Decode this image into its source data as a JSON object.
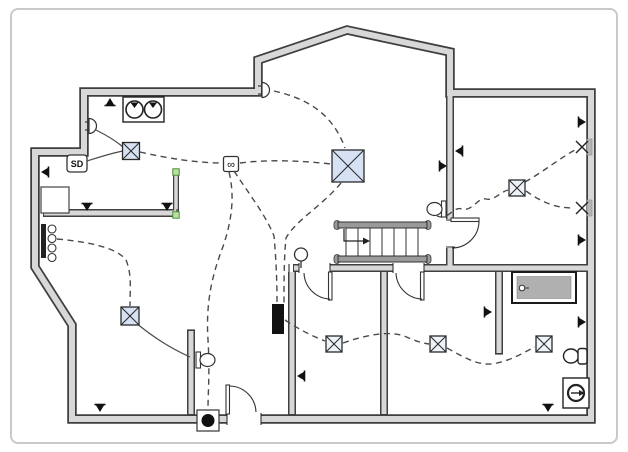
{
  "app": {
    "type": "electrical-floor-plan-diagram"
  },
  "labels": {
    "smoke_detector": "SD",
    "junction_infinity": "∞"
  },
  "colors": {
    "wall_fill": "#d8d8d8",
    "wall_edge": "#3f3f3f",
    "wire": "#4a4a4a",
    "junction_fill_blue": "#d6e2f3",
    "junction_fill_light": "#eef2f9",
    "selection_handle": "#b9e29c",
    "selection_handle_edge": "#4a8f3c",
    "frame_border": "#c9c9c9",
    "tub_fill": "#b0b0b0",
    "stair_stringer": "#9a9a9a",
    "panel_fill": "#111111"
  },
  "symbols": {
    "duplex_outlets": [
      {
        "x": 110,
        "y": 98,
        "rot": 0
      },
      {
        "x": 41,
        "y": 172,
        "rot": -90
      },
      {
        "x": 87,
        "y": 211,
        "rot": 180
      },
      {
        "x": 167,
        "y": 211,
        "rot": 180
      },
      {
        "x": 100,
        "y": 412,
        "rot": 180
      },
      {
        "x": 297,
        "y": 376,
        "rot": -90
      },
      {
        "x": 548,
        "y": 412,
        "rot": 180
      },
      {
        "x": 586,
        "y": 122,
        "rot": 90
      },
      {
        "x": 586,
        "y": 240,
        "rot": 90
      },
      {
        "x": 586,
        "y": 322,
        "rot": 90
      },
      {
        "x": 492,
        "y": 312,
        "rot": 90
      },
      {
        "x": 455,
        "y": 151,
        "rot": -90
      },
      {
        "x": 447,
        "y": 166,
        "rot": 90
      }
    ],
    "junction_boxes": [
      {
        "x": 348,
        "y": 166,
        "size": 32,
        "fill": "#d6e2f3"
      },
      {
        "x": 131,
        "y": 151,
        "size": 17,
        "fill": "#d6e2f3"
      },
      {
        "x": 130,
        "y": 316,
        "size": 18,
        "fill": "#d6e2f3"
      },
      {
        "x": 334,
        "y": 344,
        "size": 16,
        "fill": "#eef2f9"
      },
      {
        "x": 438,
        "y": 344,
        "size": 16,
        "fill": "#eef2f9"
      },
      {
        "x": 544,
        "y": 344,
        "size": 16,
        "fill": "#eef2f9"
      },
      {
        "x": 517,
        "y": 188,
        "size": 16,
        "fill": "#eef2f9"
      }
    ],
    "wall_x_lights": [
      {
        "x": 582,
        "y": 147
      },
      {
        "x": 582,
        "y": 208
      }
    ],
    "dome_wall_lights": [
      {
        "x": 262,
        "y": 90
      },
      {
        "x": 89,
        "y": 126
      }
    ],
    "oval_wall_lights": [
      {
        "x": 446,
        "y": 209,
        "dir": -1
      },
      {
        "x": 196,
        "y": 360,
        "dir": 1
      }
    ],
    "selection_handles": [
      {
        "x": 176,
        "y": 172
      },
      {
        "x": 176,
        "y": 215
      }
    ]
  },
  "wires": {
    "dashed": [
      "M274,91 C305,98 332,112 345,148",
      "M140,152 C170,159 200,163 222,163",
      "M240,163 C270,159 305,161 331,164",
      "M57,239 C88,242 116,247 126,260 C132,274 130,290 130,306",
      "M229,172 C236,200 230,228 221,252 C210,282 206,308 208,340 C210,372 208,392 208,409",
      "M234,171 C252,198 266,216 274,236 C276,258 277,280 277,303",
      "M341,183 C322,206 296,220 286,238 C284,258 284,280 284,303",
      "M285,320 C300,330 312,336 325,341",
      "M343,343 C368,334 390,331 404,336 C414,340 420,343 429,344",
      "M447,348 C467,359 480,367 497,363 C515,359 526,351 535,347",
      "M437,216 C449,221 452,206 462,209 C472,212 478,197 486,199 C494,201 500,192 508,190",
      "M525,182 C543,172 560,158 575,150",
      "M526,191 C544,204 558,208 573,208"
    ],
    "solid": [
      "M136,323 C152,336 168,347 190,357",
      "M87,161 C103,156 112,153 123,151",
      "M96,130 C108,136 116,141 123,147"
    ]
  }
}
